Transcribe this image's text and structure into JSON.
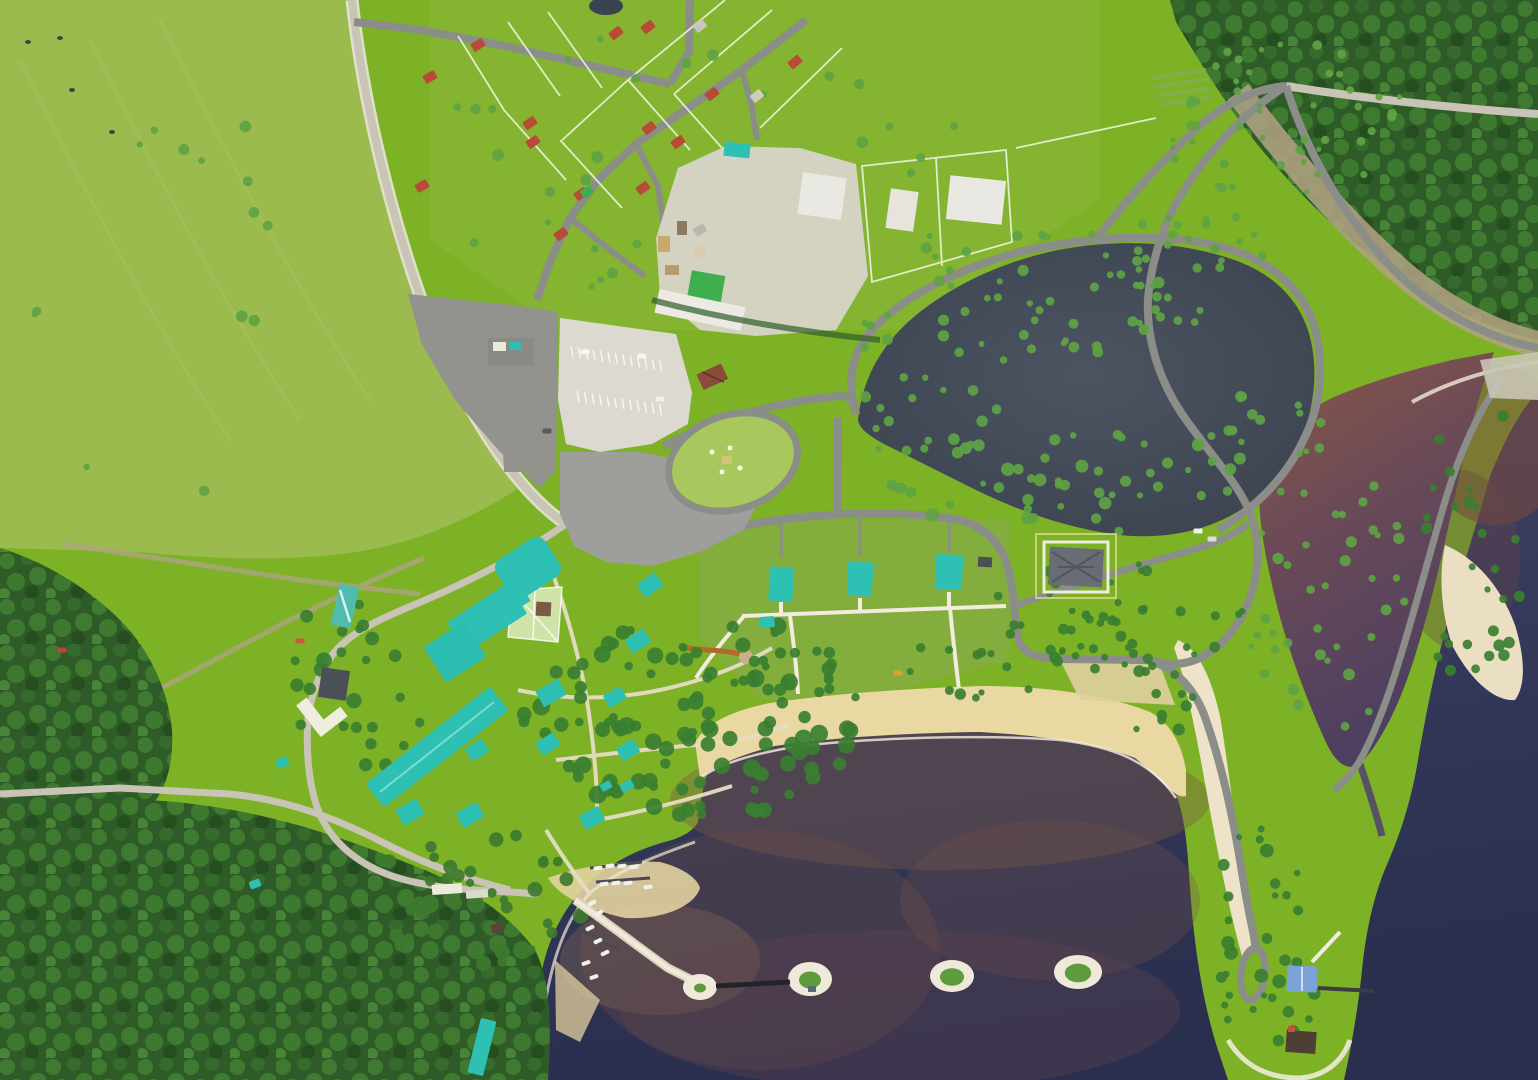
{
  "scene": {
    "type": "aerial-photograph",
    "subject": "lakeside-resort-complex"
  },
  "palette": {
    "field": "#7db227",
    "pasture": "#9cbb4e",
    "plotTint": "#8fb53c",
    "scrub": "#8aa851",
    "forest": "#2e5b27",
    "forestLight": "#3e7a2f",
    "forestDeep": "#254d20",
    "treeGreen": "#3a7f31",
    "treeLight": "#5ea344",
    "waterPond": "#48505d",
    "waterPondDark": "#3b424e",
    "waterLake": "#35395a",
    "waterDeep": "#2b2f4e",
    "lagoonTop": "#8a5847",
    "lagoonBottom": "#4c3f60",
    "eastTop": "#7a4a3e",
    "murk": "#7b5947",
    "roadAsphalt": "#8b8d88",
    "roadGravel": "#c9c4b6",
    "roadDirt": "#b3a285",
    "pathSand": "#e6ddc2",
    "pathWhite": "#f1ecdd",
    "plaza": "#9e9e9a",
    "plazaDark": "#93938d",
    "parking": "#dcd9d1",
    "sand": "#e9d8a2",
    "shoreWhite": "#efe9d9",
    "roofTeal": "#2fc0b4",
    "roofRed": "#b94a38",
    "roofGreen": "#3fae4e",
    "roofDark": "#4b4f57",
    "roofBlue": "#7ba3d8",
    "roofBrown": "#4e3e33",
    "roofGate": "#8a4a3c",
    "roofWhite": "#eceada",
    "mansionRoof": "#686c74",
    "boardwalk": "#b5672a",
    "court": "#cfe3a8",
    "fenceWhite": "#ffffff"
  },
  "features": {
    "cabins": [
      [
        650,
        585,
        22,
        16,
        -35
      ],
      [
        638,
        641,
        22,
        16,
        -33
      ],
      [
        551,
        693,
        26,
        18,
        -30
      ],
      [
        615,
        697,
        20,
        14,
        -30
      ],
      [
        548,
        744,
        21,
        15,
        -32
      ],
      [
        628,
        750,
        20,
        15,
        -30
      ],
      [
        477,
        750,
        20,
        15,
        -30
      ],
      [
        592,
        818,
        22,
        16,
        -28
      ],
      [
        470,
        815,
        24,
        17,
        -30
      ],
      [
        410,
        812,
        24,
        18,
        -30
      ],
      [
        627,
        786,
        13,
        9,
        -30
      ],
      [
        606,
        786,
        11,
        8,
        -28
      ],
      [
        767,
        622,
        15,
        11,
        -5
      ],
      [
        255,
        884,
        11,
        8,
        -20
      ],
      [
        482,
        1047,
        16,
        56,
        14
      ]
    ],
    "lodges": [
      [
        781,
        584,
        24,
        34,
        3
      ],
      [
        860,
        579,
        25,
        34,
        3
      ],
      [
        949,
        572,
        27,
        35,
        3
      ]
    ],
    "houses_red": [
      [
        648,
        27,
        -38
      ],
      [
        616,
        33,
        -38
      ],
      [
        530,
        123,
        -35
      ],
      [
        533,
        142,
        -35
      ],
      [
        649,
        128,
        -38
      ],
      [
        678,
        142,
        -36
      ],
      [
        712,
        94,
        -38
      ],
      [
        795,
        62,
        -40
      ],
      [
        643,
        188,
        -35
      ],
      [
        581,
        194,
        -33
      ],
      [
        561,
        234,
        -35
      ],
      [
        430,
        77,
        -30
      ],
      [
        478,
        45,
        -32
      ],
      [
        422,
        186,
        -30
      ]
    ],
    "houses_misc": [
      [
        700,
        26,
        -38,
        "#c9c6bd"
      ],
      [
        757,
        96,
        -38,
        "#cfccc2"
      ],
      [
        700,
        230,
        -30,
        "#b9b6ac"
      ],
      [
        587,
        192,
        -33,
        "#3fae4e"
      ],
      [
        497,
        928,
        -20,
        "#5a4636"
      ]
    ],
    "islands": [
      [
        700,
        987,
        17,
        13,
        0.35
      ],
      [
        810,
        979,
        22,
        17,
        0.5
      ],
      [
        952,
        976,
        22,
        16,
        0.55
      ],
      [
        1078,
        972,
        24,
        17,
        0.55
      ]
    ],
    "boats": [
      [
        598,
        868,
        -8
      ],
      [
        610,
        866,
        -8
      ],
      [
        622,
        866,
        -8
      ],
      [
        634,
        867,
        -8
      ],
      [
        604,
        884,
        -8
      ],
      [
        616,
        883,
        -8
      ],
      [
        628,
        883,
        -8
      ],
      [
        648,
        887,
        -8
      ],
      [
        592,
        903,
        -30
      ],
      [
        599,
        913,
        -30
      ],
      [
        590,
        928,
        -25
      ],
      [
        598,
        941,
        -25
      ],
      [
        605,
        953,
        -25
      ],
      [
        586,
        963,
        -20
      ],
      [
        594,
        977,
        -20
      ]
    ],
    "cars": [
      [
        585,
        352,
        "#f5f5f2"
      ],
      [
        642,
        356,
        "#f5f5f2"
      ],
      [
        612,
        396,
        "#d9d9d6"
      ],
      [
        660,
        399,
        "#f0f0ee"
      ],
      [
        547,
        431,
        "#55585c"
      ],
      [
        62,
        650,
        "#c04040"
      ],
      [
        300,
        641,
        "#cc5544"
      ],
      [
        1198,
        531,
        "#f2f2ef"
      ],
      [
        1212,
        539,
        "#dddcd8"
      ],
      [
        898,
        673,
        "#d9a42c"
      ]
    ],
    "cows": [
      [
        28,
        42
      ],
      [
        72,
        90
      ],
      [
        112,
        132
      ],
      [
        60,
        38
      ]
    ],
    "parking_rows": [
      {
        "x": 571,
        "y": 346,
        "n": 13,
        "dx": 7.4,
        "dy": 1.2,
        "len": 11
      },
      {
        "x": 577,
        "y": 391,
        "n": 12,
        "dx": 7.5,
        "dy": 1.2,
        "len": 11
      }
    ],
    "tree_clusters": [
      {
        "x": 690,
        "y": 718,
        "rx": 168,
        "ry": 108,
        "n": 110,
        "rmin": 4,
        "rmax": 9,
        "color": "treeGreen",
        "seed": 7
      },
      {
        "x": 1060,
        "y": 482,
        "rx": 200,
        "ry": 52,
        "n": 46,
        "rmin": 3,
        "rmax": 7,
        "color": "treeLight",
        "seed": 11
      },
      {
        "x": 1080,
        "y": 266,
        "rx": 195,
        "ry": 38,
        "n": 26,
        "rmin": 3,
        "rmax": 6,
        "color": "treeLight",
        "seed": 13
      },
      {
        "x": 1285,
        "y": 130,
        "rx": 125,
        "ry": 92,
        "n": 48,
        "rmin": 2.5,
        "rmax": 5,
        "color": "treeLight",
        "seed": 17
      },
      {
        "x": 1120,
        "y": 614,
        "rx": 138,
        "ry": 52,
        "n": 40,
        "rmin": 3,
        "rmax": 6,
        "color": "treeGreen",
        "seed": 19
      },
      {
        "x": 1268,
        "y": 940,
        "rx": 70,
        "ry": 115,
        "n": 34,
        "rmin": 3,
        "rmax": 7,
        "color": "treeGreen",
        "seed": 23
      },
      {
        "x": 1330,
        "y": 600,
        "rx": 85,
        "ry": 155,
        "n": 40,
        "rmin": 3,
        "rmax": 6,
        "color": "treeLight",
        "seed": 29
      },
      {
        "x": 1472,
        "y": 545,
        "rx": 50,
        "ry": 165,
        "n": 28,
        "rmin": 3,
        "rmax": 6,
        "color": "treeGreen",
        "seed": 31
      },
      {
        "x": 700,
        "y": 170,
        "rx": 270,
        "ry": 155,
        "n": 36,
        "rmin": 3,
        "rmax": 6,
        "color": "treeLight",
        "seed": 37
      },
      {
        "x": 930,
        "y": 668,
        "rx": 235,
        "ry": 32,
        "n": 30,
        "rmin": 3,
        "rmax": 6,
        "color": "treeGreen",
        "seed": 41
      },
      {
        "x": 920,
        "y": 420,
        "rx": 88,
        "ry": 48,
        "n": 18,
        "rmin": 3,
        "rmax": 6,
        "color": "treeLight",
        "seed": 43
      },
      {
        "x": 1010,
        "y": 335,
        "rx": 155,
        "ry": 42,
        "n": 26,
        "rmin": 3,
        "rmax": 6,
        "color": "treeLight",
        "seed": 47
      },
      {
        "x": 160,
        "y": 300,
        "rx": 150,
        "ry": 215,
        "n": 14,
        "rmin": 3,
        "rmax": 6,
        "color": "treeLight",
        "seed": 53
      },
      {
        "x": 360,
        "y": 700,
        "rx": 78,
        "ry": 115,
        "n": 30,
        "rmin": 4,
        "rmax": 8,
        "color": "treeGreen",
        "seed": 59
      },
      {
        "x": 480,
        "y": 900,
        "rx": 115,
        "ry": 68,
        "n": 40,
        "rmin": 4,
        "rmax": 8,
        "color": "forestLight",
        "seed": 61
      },
      {
        "x": 1258,
        "y": 428,
        "rx": 65,
        "ry": 38,
        "n": 14,
        "rmin": 3,
        "rmax": 6,
        "color": "treeLight",
        "seed": 67
      },
      {
        "x": 1190,
        "y": 262,
        "rx": 88,
        "ry": 66,
        "n": 24,
        "rmin": 3,
        "rmax": 5,
        "color": "treeLight",
        "seed": 71
      },
      {
        "x": 1160,
        "y": 700,
        "rx": 38,
        "ry": 38,
        "n": 12,
        "rmin": 3,
        "rmax": 6,
        "color": "treeGreen",
        "seed": 73
      }
    ]
  }
}
